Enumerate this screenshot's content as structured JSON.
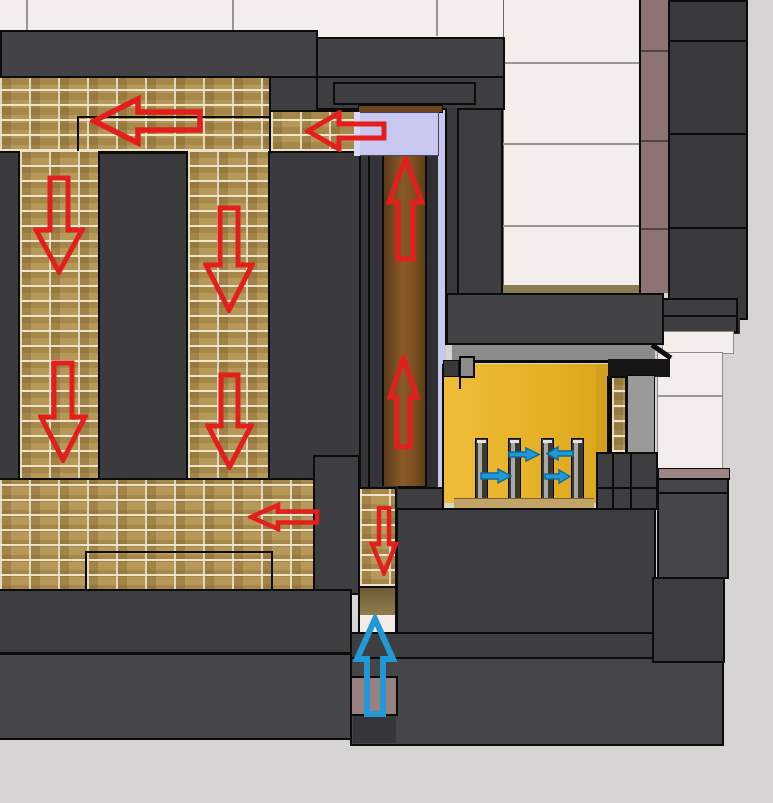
{
  "meta": {
    "width": 773,
    "height": 803,
    "view": "3d-cutaway-section",
    "subject": "masonry heater fireplace cross-section with gas and air flow arrows"
  },
  "colors": {
    "floor": "#d6d5d3",
    "cream": "#f5edeb",
    "mauve": "#8d7371",
    "mauve_sill": "#9d8583",
    "mauve_duct": "#96817f",
    "dark_block": "#3e3e40",
    "dark_block_2": "#464649",
    "dark_block_3": "#39393b",
    "brick": "#b2934f",
    "mortar": "#e8e0c6",
    "riser_brown": "#7a4e20",
    "lavender": "#c7c7ef",
    "firebox_yellow": "#e4af24",
    "hearth_tan": "#c2a468",
    "olive": "#8a7c52",
    "metal_gray": "#9a9a9a",
    "opening_gray": "#8b8b8b",
    "hot_arrow": "#e41e1c",
    "air_arrow": "#2199d8"
  },
  "flow_arrows": {
    "hot_gas_color": "#e41e1c",
    "air_color": "#2199d8",
    "hot_gas": [
      {
        "id": "top-channel-left-large",
        "direction": "left"
      },
      {
        "id": "bypass-to-top-channel",
        "direction": "left"
      },
      {
        "id": "downdraft-left-upper",
        "direction": "down"
      },
      {
        "id": "downdraft-right-upper",
        "direction": "down"
      },
      {
        "id": "downdraft-left-lower",
        "direction": "down"
      },
      {
        "id": "downdraft-right-lower",
        "direction": "down"
      },
      {
        "id": "riser-upper",
        "direction": "up"
      },
      {
        "id": "riser-lower",
        "direction": "up"
      },
      {
        "id": "bottom-channel-left",
        "direction": "left"
      },
      {
        "id": "exhaust-duct-down",
        "direction": "down"
      }
    ],
    "air": [
      {
        "id": "intake-duct-up",
        "direction": "up"
      },
      {
        "id": "grate-air-1",
        "direction": "right"
      },
      {
        "id": "grate-air-2",
        "direction": "left"
      },
      {
        "id": "grate-air-3",
        "direction": "right"
      },
      {
        "id": "grate-air-4",
        "direction": "right"
      }
    ]
  }
}
